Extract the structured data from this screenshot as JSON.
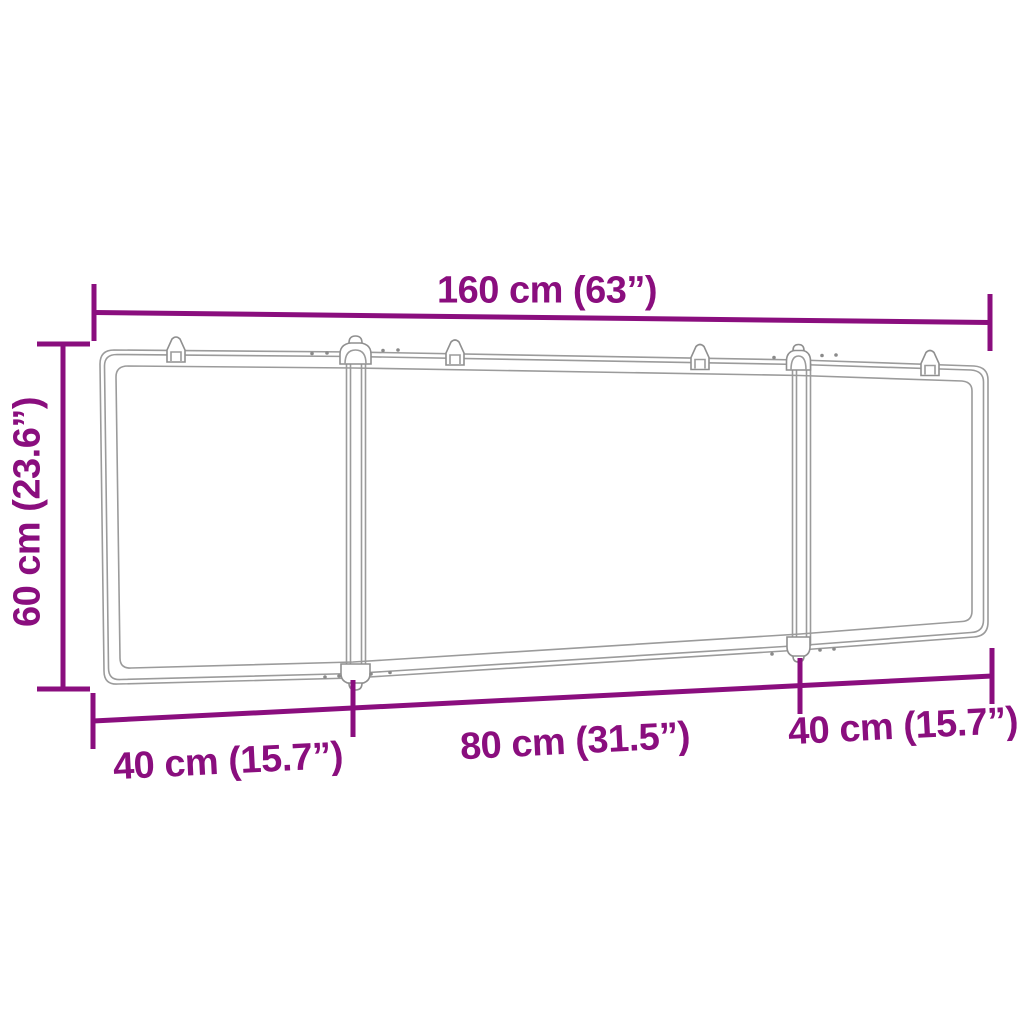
{
  "diagram": {
    "title": "foldable whiteboard dimension diagram",
    "panels_count": 3,
    "wall_hooks_count": 4,
    "labels": {
      "top_width": "160 cm (63”)",
      "left_height": "60 cm (23.6”)",
      "bottom_left_width": "40 cm (15.7”)",
      "bottom_center_width": "80 cm (31.5”)",
      "bottom_right_width": "40 cm (15.7”)"
    },
    "colors": {
      "dimension_accent": "#8a0e7e",
      "line_art_gray": "#9b9b9b",
      "background": "#ffffff"
    }
  }
}
